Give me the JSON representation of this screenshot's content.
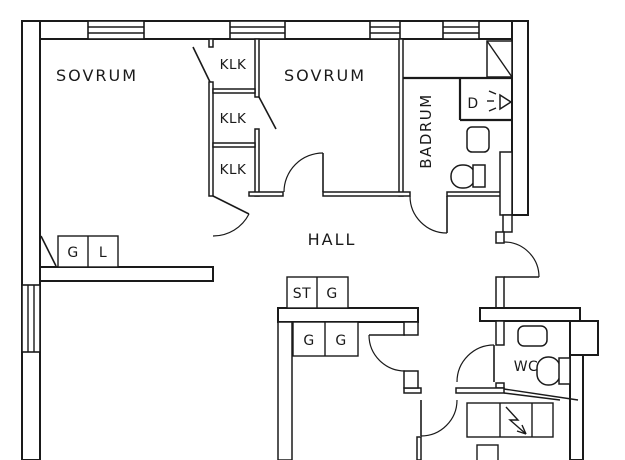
{
  "title": "Apartment floor plan",
  "colors": {
    "line": "#1a1a1a",
    "background": "#ffffff"
  },
  "rooms": {
    "bedroom_left": "SOVRUM",
    "bedroom_right": "SOVRUM",
    "bathroom": "BADRUM",
    "hall": "HALL",
    "wc": "WC",
    "shower_unit": "D"
  },
  "closets": {
    "klk_1": "KLK",
    "klk_2": "KLK",
    "klk_3": "KLK"
  },
  "cabinets": {
    "bedroom_g": "G",
    "bedroom_l": "L",
    "hall_st": "ST",
    "hall_g": "G",
    "lower_room_g1": "G",
    "lower_room_g2": "G"
  }
}
